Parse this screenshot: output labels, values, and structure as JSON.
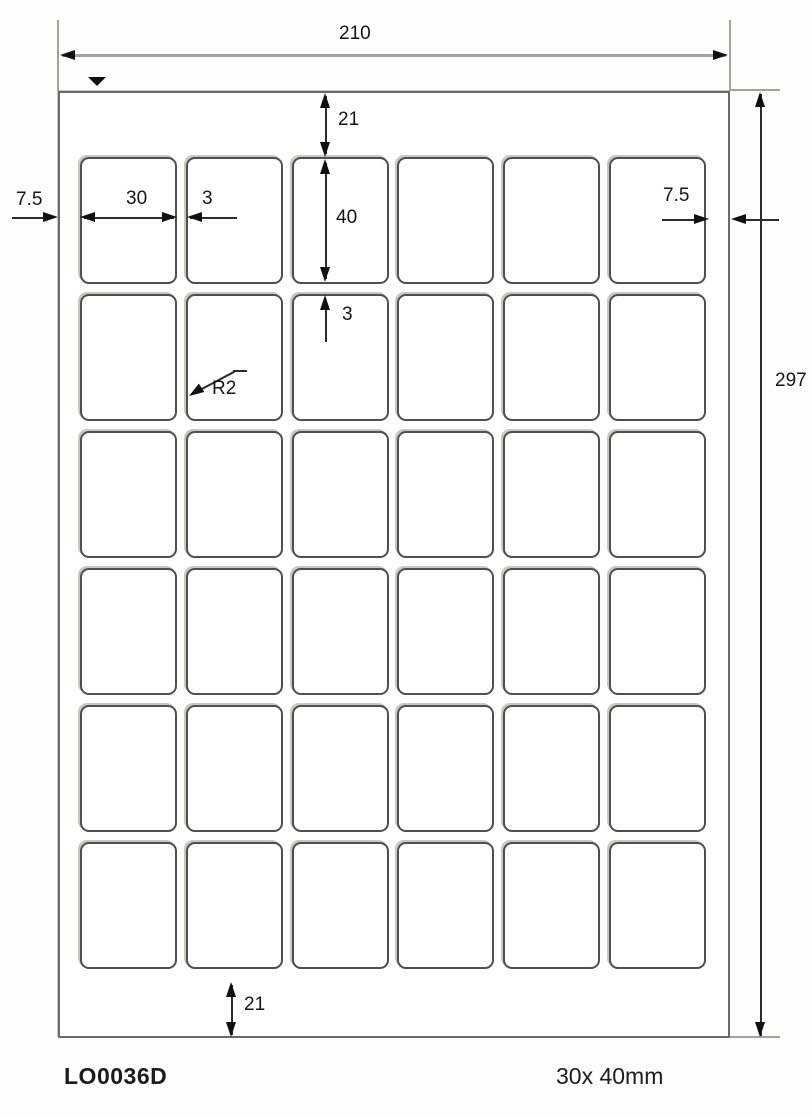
{
  "dims": {
    "sheet_width": "210",
    "sheet_height": "297",
    "margin_top": "21",
    "margin_bottom": "21",
    "margin_left": "7.5",
    "margin_right": "7.5",
    "label_width": "30",
    "label_height": "40",
    "col_gap": "3",
    "row_gap": "3",
    "corner_radius": "R2"
  },
  "grid": {
    "rows": 6,
    "cols": 6,
    "label_count": 36
  },
  "footer": {
    "product_code": "LO0036D",
    "label_size": "30x 40mm"
  },
  "colors": {
    "ink": "#1a1a1a",
    "extension_gray": "#a6a099",
    "sheet_border": "#6a6a6a"
  }
}
